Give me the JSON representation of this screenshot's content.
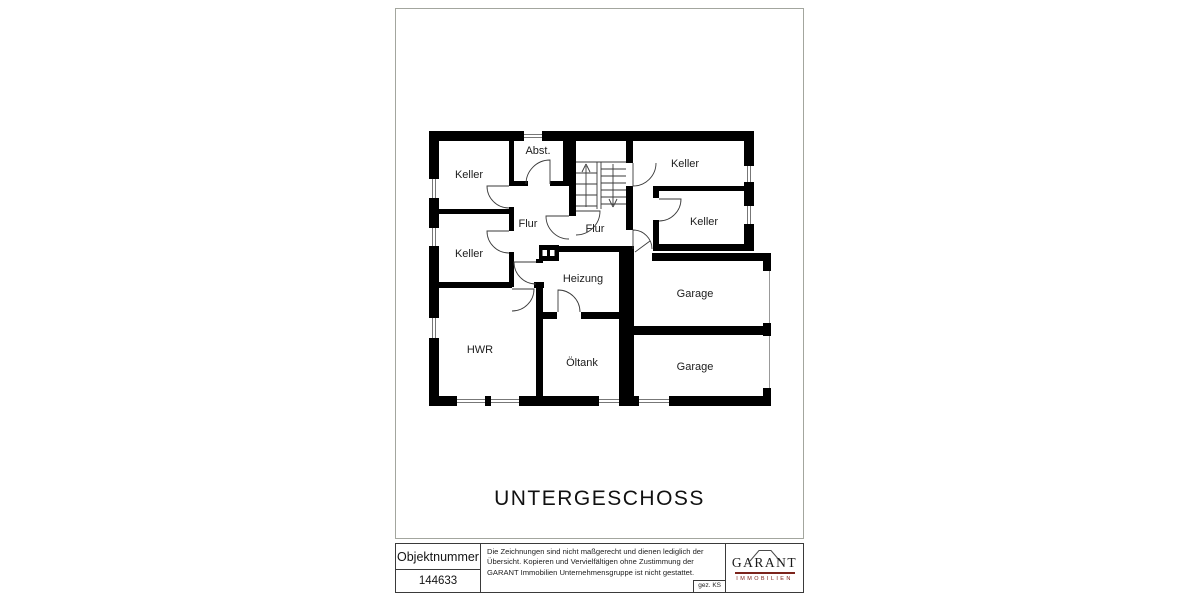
{
  "plan": {
    "title": "UNTERGESCHOSS",
    "rooms": {
      "keller_top_left": "Keller",
      "abstellraum": "Abst.",
      "keller_top_right": "Keller",
      "flur_left": "Flur",
      "flur_center": "Flur",
      "keller_mid_right": "Keller",
      "keller_mid_left": "Keller",
      "heizung": "Heizung",
      "garage_top": "Garage",
      "hwr": "HWR",
      "oeltank": "Öltank",
      "garage_bottom": "Garage"
    }
  },
  "title_block": {
    "object_number_label": "Objektnummer",
    "object_number_value": "144633",
    "disclaimer": "Die Zeichnungen sind nicht maßgerecht und dienen lediglich der Übersicht. Kopieren und Vervielfältigen ohne Zustimmung der GARANT Immobilien Unternehmensgruppe ist nicht gestattet.",
    "drawn_by": "gez. KS",
    "logo_name": "GARANT",
    "logo_subtitle": "IMMOBILIEN"
  },
  "colors": {
    "wall": "#000000",
    "logo_accent": "#7c241c",
    "paper_border": "#a3a69e"
  }
}
